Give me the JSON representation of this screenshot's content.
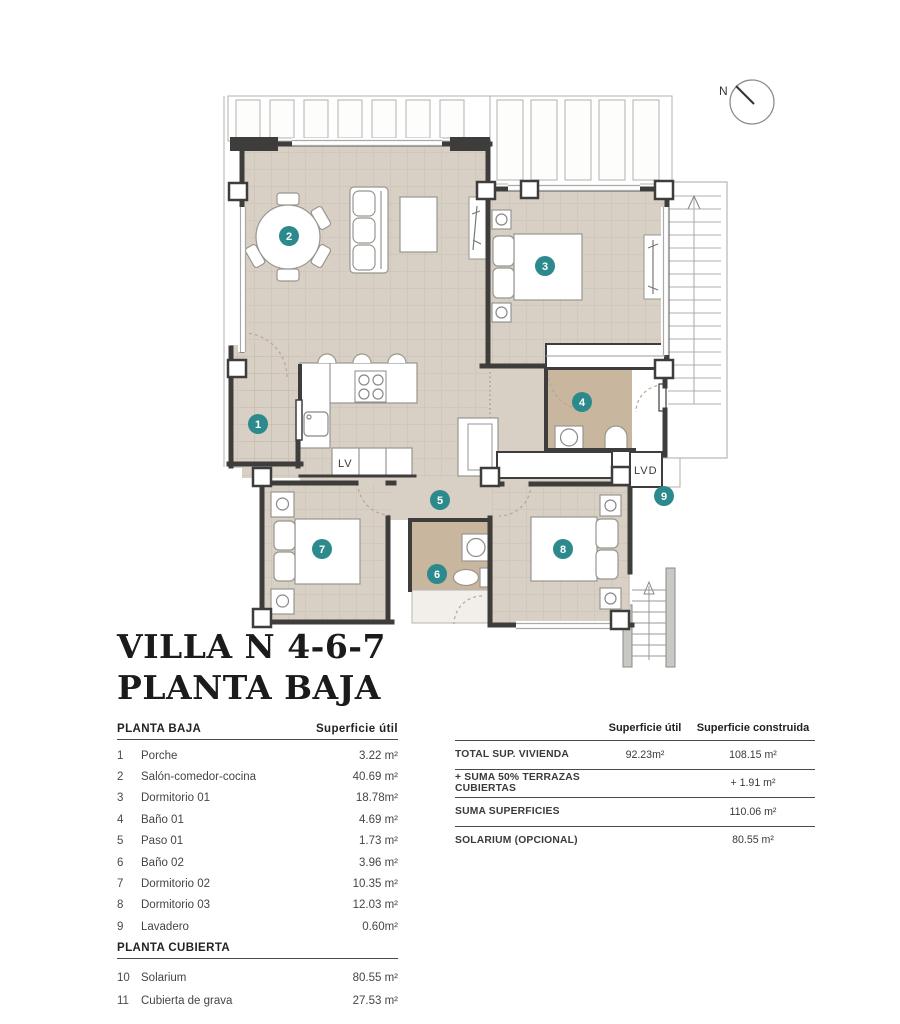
{
  "title": {
    "line1": "VILLA N 4-6-7",
    "line2": "PLANTA BAJA"
  },
  "compass": {
    "label": "N"
  },
  "plan": {
    "markers": [
      "1",
      "2",
      "3",
      "4",
      "5",
      "6",
      "7",
      "8",
      "9"
    ],
    "labels": {
      "lv": "LV",
      "lvd": "LVD"
    },
    "colors": {
      "floor": "#d8d0c5",
      "wet_floor": "#c9b69e",
      "wall": "#3e3d3b",
      "marker": "#2d8a8c"
    }
  },
  "left_table": {
    "sections": [
      {
        "header": "PLANTA BAJA",
        "col_header": "Superficie útil",
        "rows": [
          {
            "num": "1",
            "name": "Porche",
            "value": "3.22 m²"
          },
          {
            "num": "2",
            "name": "Salón-comedor-cocina",
            "value": "40.69 m²"
          },
          {
            "num": "3",
            "name": "Dormitorio 01",
            "value": "18.78m²"
          },
          {
            "num": "4",
            "name": "Baño 01",
            "value": "4.69 m²"
          },
          {
            "num": "5",
            "name": "Paso 01",
            "value": "1.73 m²"
          },
          {
            "num": "6",
            "name": "Baño 02",
            "value": "3.96 m²"
          },
          {
            "num": "7",
            "name": "Dormitorio 02",
            "value": "10.35 m²"
          },
          {
            "num": "8",
            "name": "Dormitorio 03",
            "value": "12.03 m²"
          },
          {
            "num": "9",
            "name": "Lavadero",
            "value": "0.60m²"
          }
        ]
      },
      {
        "header": "PLANTA CUBIERTA",
        "rows": [
          {
            "num": "10",
            "name": "Solarium",
            "value": "80.55 m²"
          },
          {
            "num": "11",
            "name": "Cubierta de grava",
            "value": "27.53 m²"
          }
        ]
      }
    ]
  },
  "right_table": {
    "col1": "Superficie útil",
    "col2": "Superficie construida",
    "rows": [
      {
        "label": "TOTAL SUP. VIVIENDA",
        "util": "92.23m²",
        "built": "108.15 m²"
      },
      {
        "label": "+ SUMA 50% TERRAZAS CUBIERTAS",
        "util": "",
        "built": "+ 1.91 m²"
      },
      {
        "label": "SUMA SUPERFICIES",
        "util": "",
        "built": "110.06 m²"
      },
      {
        "label": "SOLARIUM (OPCIONAL)",
        "util": "",
        "built": "80.55 m²"
      }
    ]
  }
}
